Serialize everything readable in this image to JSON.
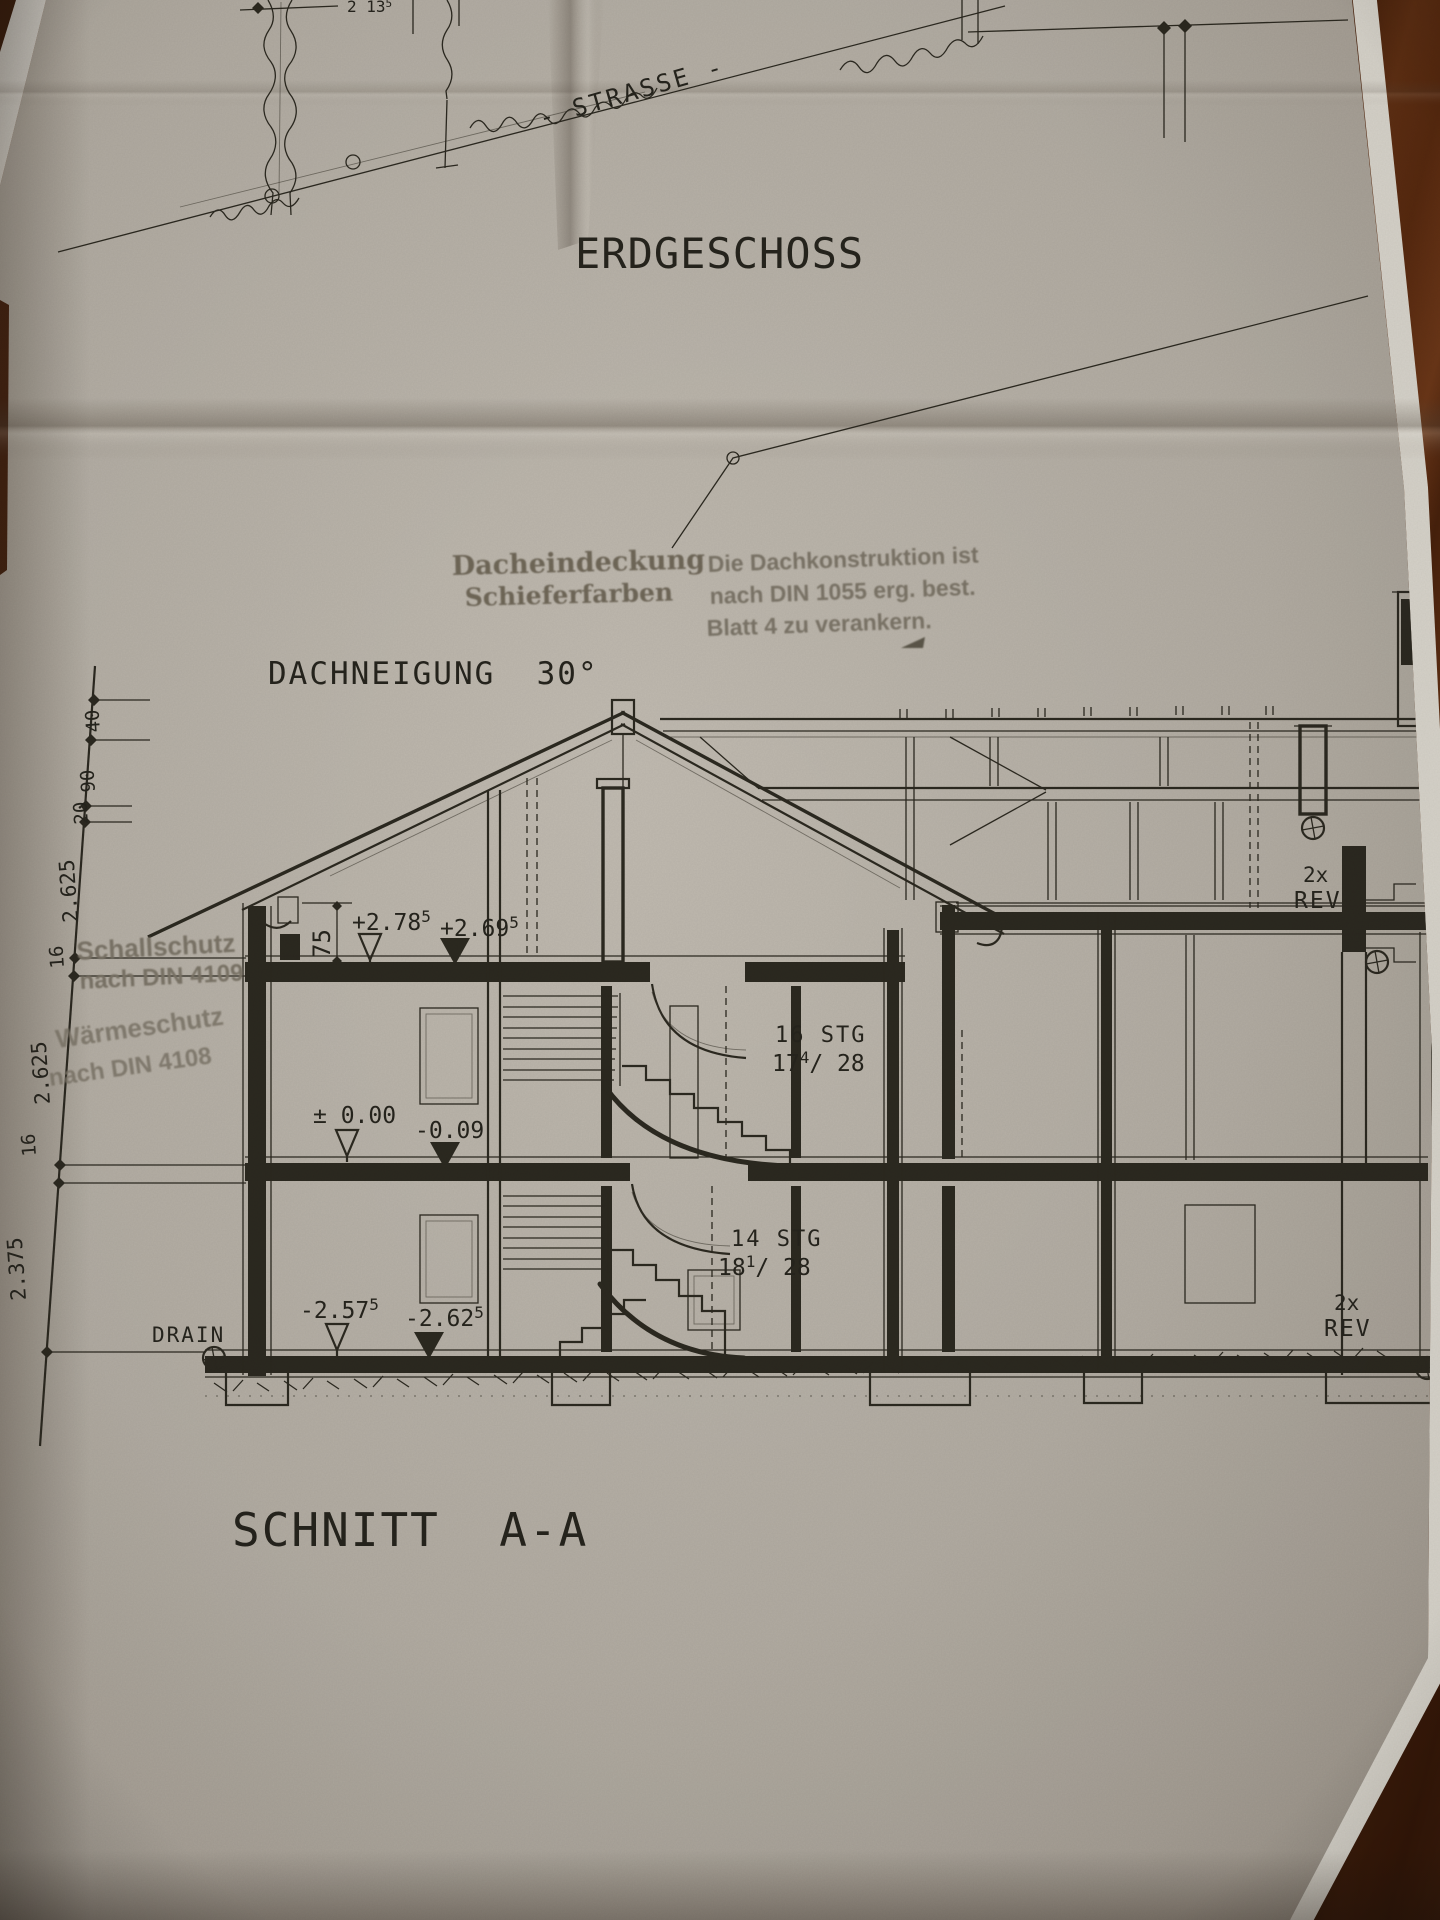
{
  "photo": {
    "paper_color": "#b3ada3",
    "wood_color": "#57290f",
    "ink_color": "#2c2920",
    "stamp_color": "#7c7567"
  },
  "site": {
    "dim": "2 13",
    "dim_sup": "5",
    "street": "- STRASSE -"
  },
  "titles": {
    "plan": "ERDGESCHOSS",
    "pitch": "DACHNEIGUNG  30°",
    "section": "SCHNITT  A-A"
  },
  "stamps": {
    "roof1": "Dacheindeckung",
    "roof2": "Schieferfarben",
    "k1": "Die Dachkonstruktion ist",
    "k2": "nach DIN 1055 erg. best.",
    "k3": "Blatt 4 zu verankern.",
    "s1": "Schallschutz",
    "s2": "nach DIN 4109",
    "w1": "Wärmeschutz",
    "w2": "nach DIN 4108"
  },
  "levels": {
    "attic_open": "+2.78",
    "attic_open_sup": "5",
    "attic_fill": "+2.69",
    "attic_fill_sup": "5",
    "eg_open": "± 0.00",
    "eg_fill": "-0.09",
    "kg_open": "-2.57",
    "kg_open_sup": "5",
    "kg_fill": "-2.62",
    "kg_fill_sup": "5",
    "eave": "75"
  },
  "stairs": {
    "up1": "16 STG",
    "up2a": "17",
    "up2sup": "4",
    "up2b": "/ 28",
    "lo1": "14 STG",
    "lo2a": "18",
    "lo2sup": "1",
    "lo2b": "/ 28"
  },
  "chain": [
    "40",
    "90",
    "20",
    "2.625",
    "16",
    "2.625",
    "16",
    "2.375"
  ],
  "marks": {
    "rev_a1": "2x",
    "rev_a2": "REV",
    "rev_b1": "2x",
    "rev_b2": "REV",
    "drain": "DRAIN"
  }
}
